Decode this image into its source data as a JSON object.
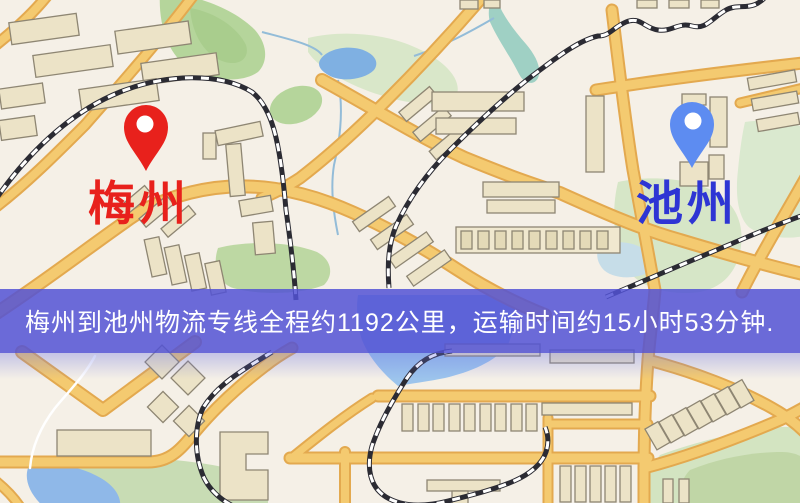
{
  "map": {
    "type": "road-map-screenshot",
    "markers": [
      {
        "id": "origin",
        "label": "梅州",
        "pin_color": "#e8211c",
        "label_color": "#e8211c"
      },
      {
        "id": "destination",
        "label": "池州",
        "pin_color": "#5d8cf1",
        "label_color": "#2e35d4"
      }
    ],
    "palette": {
      "background": "#f5f0e7",
      "road_fill": "#f4ca70",
      "road_casing": "#e3a94f",
      "water": "#7fb0e2",
      "river": "#9fd0c4",
      "park": "#bdd8a3",
      "park_pale": "#d6e6c7",
      "railway": "#2b2b33",
      "building_fill": "#ece3c7",
      "building_stroke": "#8e8673"
    }
  },
  "banner": {
    "text": "梅州到池州物流专线全程约1192公里，运输时间约15小时53分钟.",
    "from_city": "梅州",
    "to_city": "池州",
    "distance_text": "约1192公里",
    "duration_text": "约15小时53分钟",
    "background_color": "#5252d5",
    "text_color": "#ffffff"
  }
}
